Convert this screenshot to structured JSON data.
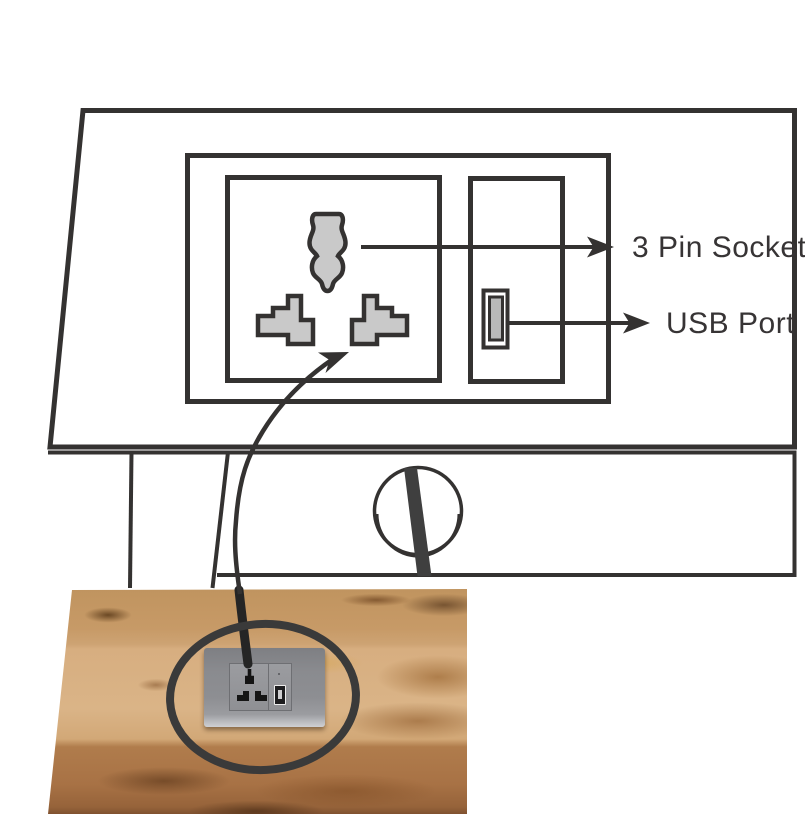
{
  "figure": {
    "background": "#ffffff",
    "labels": {
      "pin_socket": "3 Pin Socket",
      "usb_port": "USB Port"
    },
    "colors": {
      "line": "#343231",
      "text": "#373435",
      "symbol_fill": "#c9c9c9",
      "grommet_cable": "#3f3f3f",
      "annotation_ellipse": "#3a3a3a",
      "photo_cable": "#252525",
      "plate_gray": "#8d8e92",
      "wood_light": "#d9b285",
      "wood_tan": "#c79a67",
      "wood_dark": "#a87245"
    },
    "symbols": {
      "socket": "three-pin-socket-symbol",
      "usb": "usb-port-symbol",
      "grommet": "cable-grommet",
      "cable": "power-cable",
      "highlight": "ellipse-highlight"
    }
  }
}
